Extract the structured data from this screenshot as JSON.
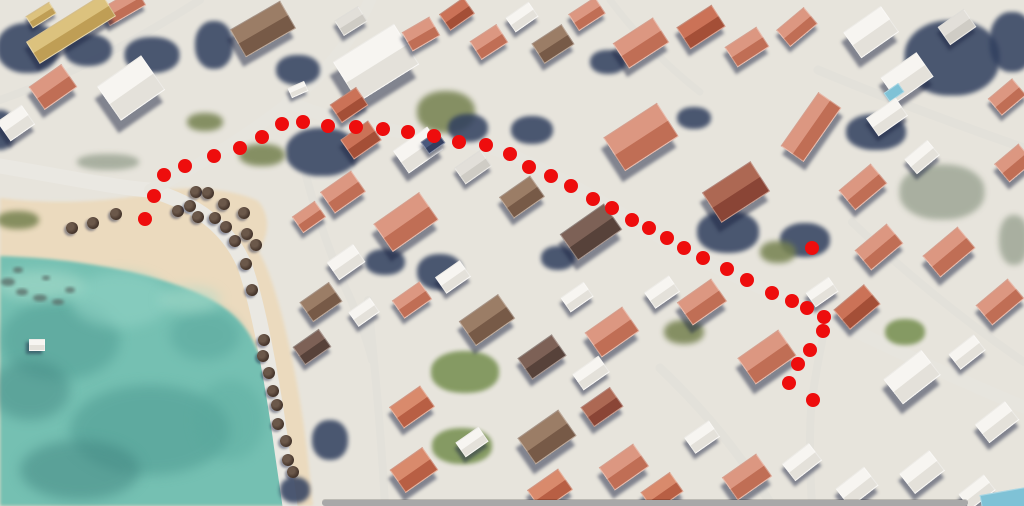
{
  "canvas": {
    "width": 1024,
    "height": 506
  },
  "route": {
    "dot_color": "#ee0d0d",
    "dot_diameter": 14,
    "points": [
      [
        145,
        219
      ],
      [
        154,
        196
      ],
      [
        164,
        175
      ],
      [
        185,
        166
      ],
      [
        214,
        156
      ],
      [
        240,
        148
      ],
      [
        262,
        137
      ],
      [
        282,
        124
      ],
      [
        303,
        122
      ],
      [
        328,
        126
      ],
      [
        356,
        127
      ],
      [
        383,
        129
      ],
      [
        408,
        132
      ],
      [
        434,
        136
      ],
      [
        459,
        142
      ],
      [
        486,
        145
      ],
      [
        510,
        154
      ],
      [
        529,
        167
      ],
      [
        551,
        176
      ],
      [
        571,
        186
      ],
      [
        593,
        199
      ],
      [
        612,
        208
      ],
      [
        632,
        220
      ],
      [
        649,
        228
      ],
      [
        667,
        238
      ],
      [
        684,
        248
      ],
      [
        703,
        258
      ],
      [
        727,
        269
      ],
      [
        747,
        280
      ],
      [
        772,
        293
      ],
      [
        792,
        301
      ],
      [
        807,
        308
      ],
      [
        824,
        317
      ],
      [
        823,
        331
      ],
      [
        810,
        350
      ],
      [
        798,
        364
      ],
      [
        789,
        383
      ],
      [
        813,
        400
      ]
    ],
    "isolated_point": [
      812,
      248
    ]
  },
  "scene": {
    "ground_color": "#e7e4dc",
    "sand_color": "#ebdabe",
    "water_color": "#74c0b2",
    "sand_path": "M0,198 C60,206 120,200 160,192 C216,202 250,228 266,266 C284,310 300,390 307,450 L313,506 L0,506 Z",
    "sand_blob_path": "M150,192 C190,184 236,190 258,201 C271,216 269,236 258,252 C240,268 214,262 194,247 C174,232 157,210 150,192 Z",
    "water_path": "M0,256 C70,258 140,270 190,290 C236,308 252,330 264,368 C276,406 288,456 294,506 L0,506 Z",
    "water_mottles": [
      [
        60,
        340,
        120,
        80,
        "#4a958d",
        0.45
      ],
      [
        150,
        430,
        160,
        90,
        "#4a958d",
        0.5
      ],
      [
        80,
        470,
        120,
        60,
        "#3f837f",
        0.5
      ],
      [
        205,
        335,
        70,
        50,
        "#53a097",
        0.45
      ],
      [
        120,
        300,
        100,
        55,
        "#93d4c6",
        0.55
      ],
      [
        40,
        285,
        90,
        30,
        "#a7dccb",
        0.6
      ],
      [
        190,
        300,
        60,
        26,
        "#a7dccb",
        0.5
      ],
      [
        230,
        420,
        70,
        80,
        "#59a89c",
        0.4
      ],
      [
        30,
        390,
        80,
        60,
        "#3f837f",
        0.45
      ]
    ],
    "rocks": [
      [
        8,
        282,
        14,
        8
      ],
      [
        22,
        292,
        12,
        7
      ],
      [
        40,
        298,
        14,
        7
      ],
      [
        58,
        302,
        12,
        6
      ],
      [
        18,
        270,
        10,
        6
      ],
      [
        70,
        290,
        10,
        6
      ],
      [
        46,
        278,
        8,
        5
      ]
    ],
    "roads": [
      [
        "M0,166 C60,176 118,188 150,190 C198,204 228,228 244,264 C258,302 272,380 280,436 C284,466 288,490 290,506",
        15,
        "#eae8e2"
      ],
      [
        "M150,190 C200,166 252,132 290,102 C322,76 352,42 370,0",
        12,
        "#e7e5de"
      ],
      [
        "M288,102 C340,124 390,130 440,138 C480,144 502,150 522,160 C562,178 602,202 642,226 C667,242 682,250 702,260 C742,280 792,302 832,320 C882,344 950,376 1012,402 L1024,407",
        13,
        "#e7e5de"
      ],
      [
        "M826,322 C820,350 814,380 811,410 C809,440 810,472 812,506",
        8,
        "#e3e1da"
      ],
      [
        "M200,0 C150,32 80,72 0,100",
        8,
        "#e3e1da"
      ],
      [
        "M818,70 C880,96 950,122 1024,148",
        9,
        "#e3e1da"
      ],
      [
        "M660,368 C700,406 740,452 772,506",
        9,
        "#e3e1da"
      ],
      [
        "M368,300 C374,360 381,430 385,506",
        8,
        "#e3e1da"
      ],
      [
        "M306,176 C318,220 333,262 351,300 C360,322 368,342 372,360",
        8,
        "#e3e1da"
      ],
      [
        "M610,0 C640,40 672,70 700,92",
        7,
        "#e3e1da"
      ],
      [
        "M852,222 C900,268 960,318 1024,362",
        8,
        "#e3e1da"
      ]
    ],
    "vegetation_palette": {
      "tree": {
        "color": "#31405f",
        "opacity": 0.86,
        "blur": 2
      },
      "olive": {
        "color": "#75814f",
        "opacity": 0.85,
        "blur": 3
      },
      "scrub": {
        "color": "#9aa392",
        "opacity": 0.8,
        "blur": 3
      },
      "green": {
        "color": "#7b9356",
        "opacity": 0.9,
        "blur": 2
      }
    },
    "vegetation": [
      [
        28,
        48,
        62,
        50,
        "tree"
      ],
      [
        88,
        50,
        48,
        32,
        "tree"
      ],
      [
        152,
        55,
        55,
        36,
        "tree"
      ],
      [
        214,
        45,
        38,
        48,
        "tree"
      ],
      [
        298,
        70,
        44,
        30,
        "tree"
      ],
      [
        322,
        152,
        72,
        48,
        "tree"
      ],
      [
        446,
        112,
        58,
        42,
        "olive"
      ],
      [
        468,
        128,
        40,
        28,
        "tree"
      ],
      [
        532,
        130,
        42,
        28,
        "tree"
      ],
      [
        728,
        232,
        62,
        42,
        "tree"
      ],
      [
        805,
        240,
        50,
        34,
        "tree"
      ],
      [
        952,
        58,
        95,
        75,
        "tree"
      ],
      [
        1012,
        42,
        45,
        60,
        "tree"
      ],
      [
        942,
        192,
        85,
        55,
        "scrub"
      ],
      [
        876,
        132,
        60,
        36,
        "tree"
      ],
      [
        465,
        372,
        68,
        42,
        "green"
      ],
      [
        462,
        446,
        60,
        36,
        "green"
      ],
      [
        262,
        155,
        46,
        22,
        "olive"
      ],
      [
        205,
        122,
        36,
        18,
        "olive"
      ],
      [
        18,
        220,
        42,
        18,
        "olive"
      ],
      [
        108,
        162,
        62,
        16,
        "scrub"
      ],
      [
        684,
        332,
        40,
        24,
        "olive"
      ],
      [
        778,
        252,
        36,
        22,
        "olive"
      ],
      [
        608,
        62,
        36,
        24,
        "tree"
      ],
      [
        694,
        118,
        34,
        22,
        "tree"
      ],
      [
        385,
        262,
        40,
        26,
        "tree"
      ],
      [
        440,
        272,
        46,
        36,
        "tree"
      ],
      [
        558,
        258,
        34,
        24,
        "tree"
      ],
      [
        905,
        332,
        40,
        26,
        "green"
      ],
      [
        0,
        130,
        30,
        40,
        "tree"
      ],
      [
        1014,
        240,
        30,
        50,
        "scrub"
      ],
      [
        330,
        440,
        36,
        40,
        "tree"
      ],
      [
        295,
        490,
        30,
        26,
        "tree"
      ]
    ],
    "roof_palette": {
      "salmon": [
        "#dc9781",
        "#c06e55"
      ],
      "brick": [
        "#cb7257",
        "#a44f37"
      ],
      "terra": [
        "#d98a6c",
        "#b85f44"
      ],
      "maroon": [
        "#ad6853",
        "#8a4536"
      ],
      "brown": [
        "#9b7d66",
        "#775a47"
      ],
      "dkbrown": [
        "#7d6156",
        "#57423a"
      ],
      "white": [
        "#f7f5f1",
        "#e4e1da"
      ],
      "ltgray": [
        "#e2dfd9",
        "#cfccc5"
      ],
      "tan": [
        "#dcc27e",
        "#bf9e55"
      ],
      "navy": [
        "#4a587c",
        "#333f60"
      ],
      "pool": [
        "#7fc2d6",
        "#4f97b4"
      ]
    },
    "buildings": [
      [
        122,
        6,
        40,
        18,
        -30,
        "salmon"
      ],
      [
        70,
        28,
        88,
        24,
        -32,
        "tan"
      ],
      [
        40,
        14,
        26,
        12,
        -32,
        "tan"
      ],
      [
        52,
        86,
        38,
        26,
        -35,
        "salmon"
      ],
      [
        130,
        87,
        52,
        40,
        -35,
        "white"
      ],
      [
        15,
        122,
        28,
        22,
        -35,
        "white"
      ],
      [
        262,
        28,
        56,
        30,
        -30,
        "brown"
      ],
      [
        375,
        62,
        70,
        46,
        -32,
        "white"
      ],
      [
        350,
        20,
        26,
        16,
        -32,
        "ltgray"
      ],
      [
        348,
        104,
        30,
        20,
        -34,
        "brick"
      ],
      [
        297,
        88,
        16,
        9,
        -24,
        "white"
      ],
      [
        420,
        33,
        30,
        20,
        -30,
        "salmon"
      ],
      [
        456,
        13,
        28,
        18,
        -35,
        "brick"
      ],
      [
        488,
        41,
        30,
        20,
        -33,
        "salmon"
      ],
      [
        521,
        16,
        26,
        16,
        -35,
        "white"
      ],
      [
        552,
        43,
        34,
        22,
        -33,
        "brown"
      ],
      [
        586,
        13,
        30,
        18,
        -33,
        "salmon"
      ],
      [
        640,
        42,
        46,
        28,
        -33,
        "salmon"
      ],
      [
        700,
        26,
        40,
        24,
        -33,
        "brick"
      ],
      [
        746,
        46,
        36,
        22,
        -33,
        "salmon"
      ],
      [
        796,
        26,
        34,
        20,
        -40,
        "salmon"
      ],
      [
        870,
        31,
        44,
        30,
        -35,
        "white"
      ],
      [
        906,
        76,
        42,
        28,
        -35,
        "white"
      ],
      [
        893,
        91,
        16,
        9,
        -35,
        "pool",
        1
      ],
      [
        956,
        26,
        30,
        20,
        -35,
        "ltgray"
      ],
      [
        1006,
        96,
        30,
        20,
        -40,
        "salmon"
      ],
      [
        1013,
        162,
        30,
        22,
        -40,
        "salmon"
      ],
      [
        360,
        139,
        32,
        22,
        -35,
        "brick"
      ],
      [
        417,
        149,
        40,
        26,
        -35,
        "white"
      ],
      [
        432,
        141,
        18,
        13,
        -35,
        "navy"
      ],
      [
        472,
        166,
        30,
        18,
        -35,
        "ltgray"
      ],
      [
        342,
        191,
        36,
        24,
        -35,
        "salmon"
      ],
      [
        308,
        216,
        26,
        18,
        -35,
        "salmon"
      ],
      [
        405,
        221,
        54,
        32,
        -35,
        "salmon"
      ],
      [
        345,
        261,
        30,
        20,
        -35,
        "white"
      ],
      [
        521,
        196,
        36,
        24,
        -35,
        "brown"
      ],
      [
        590,
        231,
        52,
        30,
        -35,
        "dkbrown"
      ],
      [
        640,
        136,
        62,
        38,
        -33,
        "salmon"
      ],
      [
        735,
        191,
        56,
        34,
        -33,
        "maroon"
      ],
      [
        810,
        126,
        64,
        26,
        -55,
        "salmon"
      ],
      [
        862,
        186,
        40,
        24,
        -40,
        "salmon"
      ],
      [
        878,
        246,
        40,
        24,
        -40,
        "salmon"
      ],
      [
        948,
        251,
        44,
        26,
        -40,
        "salmon"
      ],
      [
        999,
        301,
        40,
        24,
        -40,
        "salmon"
      ],
      [
        921,
        156,
        28,
        18,
        -40,
        "white"
      ],
      [
        886,
        116,
        34,
        20,
        -35,
        "white"
      ],
      [
        320,
        301,
        34,
        22,
        -35,
        "brown"
      ],
      [
        311,
        346,
        30,
        20,
        -35,
        "dkbrown"
      ],
      [
        363,
        311,
        24,
        16,
        -35,
        "white"
      ],
      [
        411,
        299,
        32,
        20,
        -35,
        "salmon"
      ],
      [
        452,
        276,
        28,
        18,
        -35,
        "white"
      ],
      [
        486,
        319,
        46,
        28,
        -35,
        "brown"
      ],
      [
        541,
        356,
        40,
        24,
        -35,
        "dkbrown"
      ],
      [
        611,
        331,
        44,
        28,
        -35,
        "salmon"
      ],
      [
        576,
        296,
        26,
        16,
        -35,
        "white"
      ],
      [
        661,
        291,
        28,
        18,
        -35,
        "white"
      ],
      [
        701,
        301,
        40,
        26,
        -35,
        "salmon"
      ],
      [
        766,
        356,
        48,
        30,
        -35,
        "salmon"
      ],
      [
        821,
        291,
        26,
        16,
        -35,
        "white"
      ],
      [
        856,
        306,
        38,
        24,
        -40,
        "brick"
      ],
      [
        911,
        376,
        46,
        30,
        -38,
        "white"
      ],
      [
        966,
        351,
        30,
        18,
        -38,
        "white"
      ],
      [
        996,
        421,
        36,
        22,
        -38,
        "white"
      ],
      [
        411,
        406,
        36,
        24,
        -35,
        "terra"
      ],
      [
        413,
        469,
        38,
        26,
        -35,
        "terra"
      ],
      [
        471,
        441,
        26,
        16,
        -35,
        "white"
      ],
      [
        546,
        436,
        48,
        30,
        -35,
        "brown"
      ],
      [
        601,
        406,
        34,
        22,
        -35,
        "maroon"
      ],
      [
        623,
        466,
        40,
        26,
        -35,
        "salmon"
      ],
      [
        549,
        489,
        36,
        24,
        -35,
        "terra"
      ],
      [
        661,
        491,
        34,
        22,
        -35,
        "terra"
      ],
      [
        701,
        436,
        28,
        18,
        -35,
        "white"
      ],
      [
        746,
        476,
        40,
        26,
        -35,
        "salmon"
      ],
      [
        801,
        461,
        32,
        20,
        -38,
        "white"
      ],
      [
        856,
        486,
        34,
        22,
        -38,
        "white"
      ],
      [
        921,
        471,
        36,
        24,
        -38,
        "white"
      ],
      [
        976,
        491,
        30,
        18,
        -38,
        "white"
      ],
      [
        1003,
        500,
        44,
        18,
        -10,
        "pool",
        1
      ],
      [
        36,
        344,
        14,
        10,
        0,
        "white"
      ],
      [
        590,
        372,
        30,
        18,
        -35,
        "white"
      ]
    ],
    "umbrellas": {
      "color_outer": "#3f2f26",
      "color_inner": "#6b584a",
      "diameter": 12,
      "positions": [
        [
          72,
          228
        ],
        [
          93,
          223
        ],
        [
          116,
          214
        ],
        [
          178,
          211
        ],
        [
          190,
          206
        ],
        [
          196,
          192
        ],
        [
          208,
          193
        ],
        [
          198,
          217
        ],
        [
          215,
          218
        ],
        [
          224,
          204
        ],
        [
          226,
          227
        ],
        [
          235,
          241
        ],
        [
          244,
          213
        ],
        [
          247,
          234
        ],
        [
          256,
          245
        ],
        [
          246,
          264
        ],
        [
          252,
          290
        ],
        [
          264,
          340
        ],
        [
          263,
          356
        ],
        [
          269,
          373
        ],
        [
          273,
          391
        ],
        [
          277,
          405
        ],
        [
          278,
          424
        ],
        [
          286,
          441
        ],
        [
          288,
          460
        ],
        [
          293,
          472
        ]
      ]
    }
  },
  "ui": {
    "scrollbar": {
      "x": 322,
      "y": 500,
      "width": 646,
      "height": 6,
      "color": "#a8a8a8"
    }
  }
}
